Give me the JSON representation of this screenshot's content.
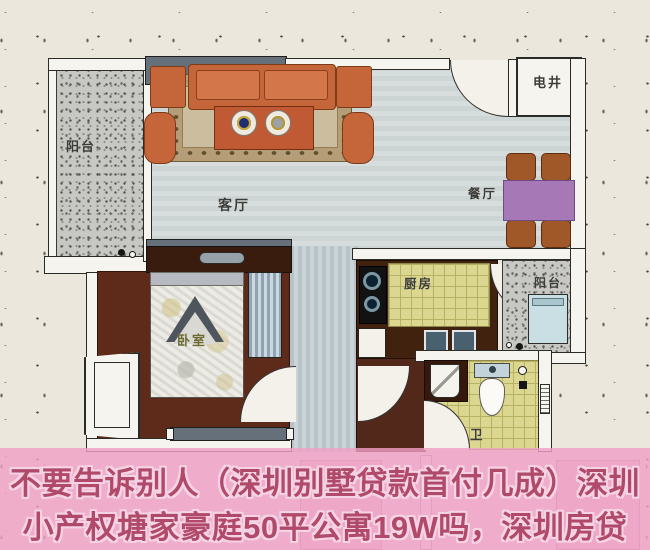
{
  "image_type": "real-estate floor plan photo with promotional caption overlay",
  "floorplan": {
    "rooms": {
      "balcony_left": {
        "label": "阳台"
      },
      "living_room": {
        "label": "客厅"
      },
      "dining_area": {
        "label": "餐厅"
      },
      "utility_shaft": {
        "label": "电井"
      },
      "kitchen": {
        "label": "厨房"
      },
      "balcony_right": {
        "label": "阳台"
      },
      "bedroom": {
        "label": "卧室"
      },
      "bathroom": {
        "label": "卫"
      }
    }
  },
  "caption": {
    "line1": "不要告诉别人（深圳别墅贷款首付几成）深圳",
    "line2": "小产权塘家豪庭50平公寓19W吗，深圳房贷"
  },
  "colors": {
    "background_paper": "#ebe7dc",
    "caption_band": "#f0a0c6",
    "caption_text": "#b14a6a",
    "living_floor": "#ced6d5",
    "tile_floor": "#dbd690",
    "bedroom_floor": "#5e2b1b",
    "balcony_floor": "#c7c7c3",
    "wall_dark": "#66707a",
    "sofa_orange": "#c4653a",
    "dining_table_purple": "#a678b6",
    "dining_chair_brown": "#a15829"
  }
}
